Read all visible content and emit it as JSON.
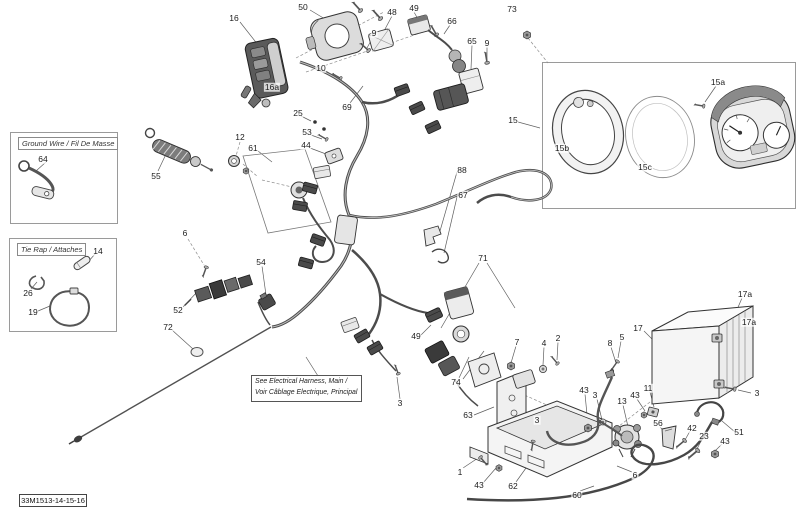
{
  "page": {
    "background": "#ffffff"
  },
  "footer_code": "33M1513-14-15-16",
  "inset_boxes": {
    "ground_wire": {
      "title": "Ground Wire / Fil De Masse"
    },
    "tie_rap": {
      "title": "Tie Rap / Attaches"
    }
  },
  "note_box": {
    "line1": "See Electrical Harness, Main /",
    "line2": "Voir Câblage Electrique, Principal"
  },
  "colors": {
    "line": "#3c3c3c",
    "leader": "#5f5f5f",
    "fill_light": "#ececec",
    "fill_mid": "#c9c9c9",
    "fill_dark": "#4a4a4a",
    "box_border": "#9a9a9a"
  },
  "callouts": [
    {
      "label": "16",
      "x": 234,
      "y": 18
    },
    {
      "label": "50",
      "x": 303,
      "y": 7
    },
    {
      "label": "9",
      "x": 374,
      "y": 33
    },
    {
      "label": "48",
      "x": 392,
      "y": 12
    },
    {
      "label": "49",
      "x": 414,
      "y": 8
    },
    {
      "label": "66",
      "x": 452,
      "y": 21
    },
    {
      "label": "73",
      "x": 512,
      "y": 9
    },
    {
      "label": "65",
      "x": 472,
      "y": 41
    },
    {
      "label": "9",
      "x": 487,
      "y": 43
    },
    {
      "label": "10",
      "x": 321,
      "y": 68
    },
    {
      "label": "16a",
      "x": 272,
      "y": 87
    },
    {
      "label": "69",
      "x": 347,
      "y": 107
    },
    {
      "label": "25",
      "x": 298,
      "y": 113
    },
    {
      "label": "53",
      "x": 307,
      "y": 132
    },
    {
      "label": "44",
      "x": 306,
      "y": 145
    },
    {
      "label": "12",
      "x": 240,
      "y": 137
    },
    {
      "label": "61",
      "x": 253,
      "y": 148
    },
    {
      "label": "55",
      "x": 156,
      "y": 176
    },
    {
      "label": "64",
      "x": 43,
      "y": 159
    },
    {
      "label": "15",
      "x": 513,
      "y": 120
    },
    {
      "label": "15a",
      "x": 718,
      "y": 82
    },
    {
      "label": "15b",
      "x": 562,
      "y": 148
    },
    {
      "label": "15c",
      "x": 645,
      "y": 167
    },
    {
      "label": "88",
      "x": 462,
      "y": 170
    },
    {
      "label": "67",
      "x": 463,
      "y": 195
    },
    {
      "label": "6",
      "x": 185,
      "y": 233
    },
    {
      "label": "14",
      "x": 98,
      "y": 251
    },
    {
      "label": "26",
      "x": 28,
      "y": 293
    },
    {
      "label": "19",
      "x": 33,
      "y": 312
    },
    {
      "label": "52",
      "x": 178,
      "y": 310
    },
    {
      "label": "72",
      "x": 168,
      "y": 327
    },
    {
      "label": "54",
      "x": 261,
      "y": 262
    },
    {
      "label": "71",
      "x": 483,
      "y": 258
    },
    {
      "label": "49",
      "x": 416,
      "y": 336
    },
    {
      "label": "74",
      "x": 456,
      "y": 382
    },
    {
      "label": "3",
      "x": 400,
      "y": 403
    },
    {
      "label": "7",
      "x": 517,
      "y": 342
    },
    {
      "label": "4",
      "x": 544,
      "y": 343
    },
    {
      "label": "2",
      "x": 558,
      "y": 338
    },
    {
      "label": "8",
      "x": 610,
      "y": 343
    },
    {
      "label": "5",
      "x": 622,
      "y": 337
    },
    {
      "label": "17",
      "x": 638,
      "y": 328
    },
    {
      "label": "17a",
      "x": 745,
      "y": 294
    },
    {
      "label": "17a",
      "x": 749,
      "y": 322
    },
    {
      "label": "3",
      "x": 757,
      "y": 393
    },
    {
      "label": "63",
      "x": 468,
      "y": 415
    },
    {
      "label": "3",
      "x": 537,
      "y": 420
    },
    {
      "label": "43",
      "x": 584,
      "y": 390
    },
    {
      "label": "3",
      "x": 595,
      "y": 395
    },
    {
      "label": "13",
      "x": 622,
      "y": 401
    },
    {
      "label": "43",
      "x": 635,
      "y": 395
    },
    {
      "label": "11",
      "x": 648,
      "y": 388
    },
    {
      "label": "56",
      "x": 658,
      "y": 423
    },
    {
      "label": "42",
      "x": 692,
      "y": 428
    },
    {
      "label": "23",
      "x": 704,
      "y": 436
    },
    {
      "label": "43",
      "x": 725,
      "y": 441
    },
    {
      "label": "51",
      "x": 739,
      "y": 432
    },
    {
      "label": "1",
      "x": 460,
      "y": 472
    },
    {
      "label": "43",
      "x": 479,
      "y": 485
    },
    {
      "label": "62",
      "x": 513,
      "y": 486
    },
    {
      "label": "60",
      "x": 577,
      "y": 495
    },
    {
      "label": "6",
      "x": 635,
      "y": 475
    }
  ]
}
